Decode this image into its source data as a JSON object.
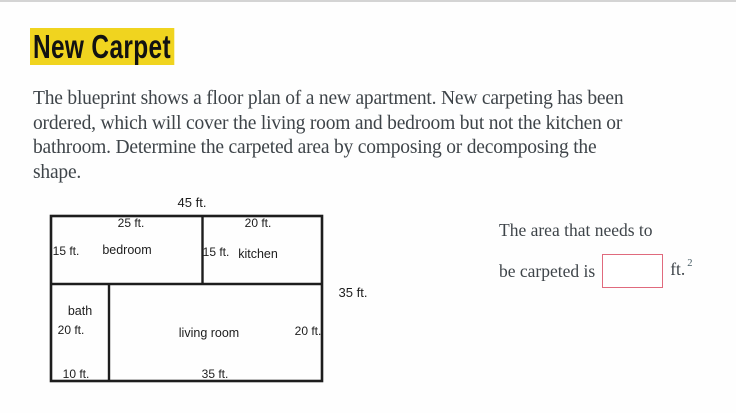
{
  "page": {
    "title": "New Carpet",
    "description_lines": [
      "The blueprint shows a floor plan of a new apartment. New carpeting has been",
      "ordered, which will cover the living room and bedroom but not the kitchen or",
      "bathroom. Determine the carpeted area by composing or decomposing the",
      "shape."
    ]
  },
  "floorplan": {
    "overall_width_label": "45 ft.",
    "overall_height_label": "35 ft.",
    "rooms": {
      "bedroom": {
        "name": "bedroom",
        "width_label": "25 ft.",
        "height_label": "15 ft."
      },
      "kitchen": {
        "name": "kitchen",
        "width_label": "20 ft.",
        "height_label": "15 ft."
      },
      "bath": {
        "name": "bath",
        "width_label": "10 ft.",
        "height_label": "20 ft."
      },
      "living_room": {
        "name": "living room",
        "width_label": "35 ft.",
        "height_label": "20 ft."
      }
    }
  },
  "answer": {
    "prompt_line1": "The area that needs to",
    "prompt_line2": "be carpeted is",
    "input_value": "",
    "unit": "ft.",
    "unit_exponent": "2"
  },
  "colors": {
    "title_highlight": "#f0d41f",
    "title_text": "#121212",
    "body_text": "#3e4449",
    "floorplan_line": "#1d1d1d",
    "input_border": "#e06a7d",
    "top_border": "#d4d4d4",
    "background": "#fefefe"
  }
}
